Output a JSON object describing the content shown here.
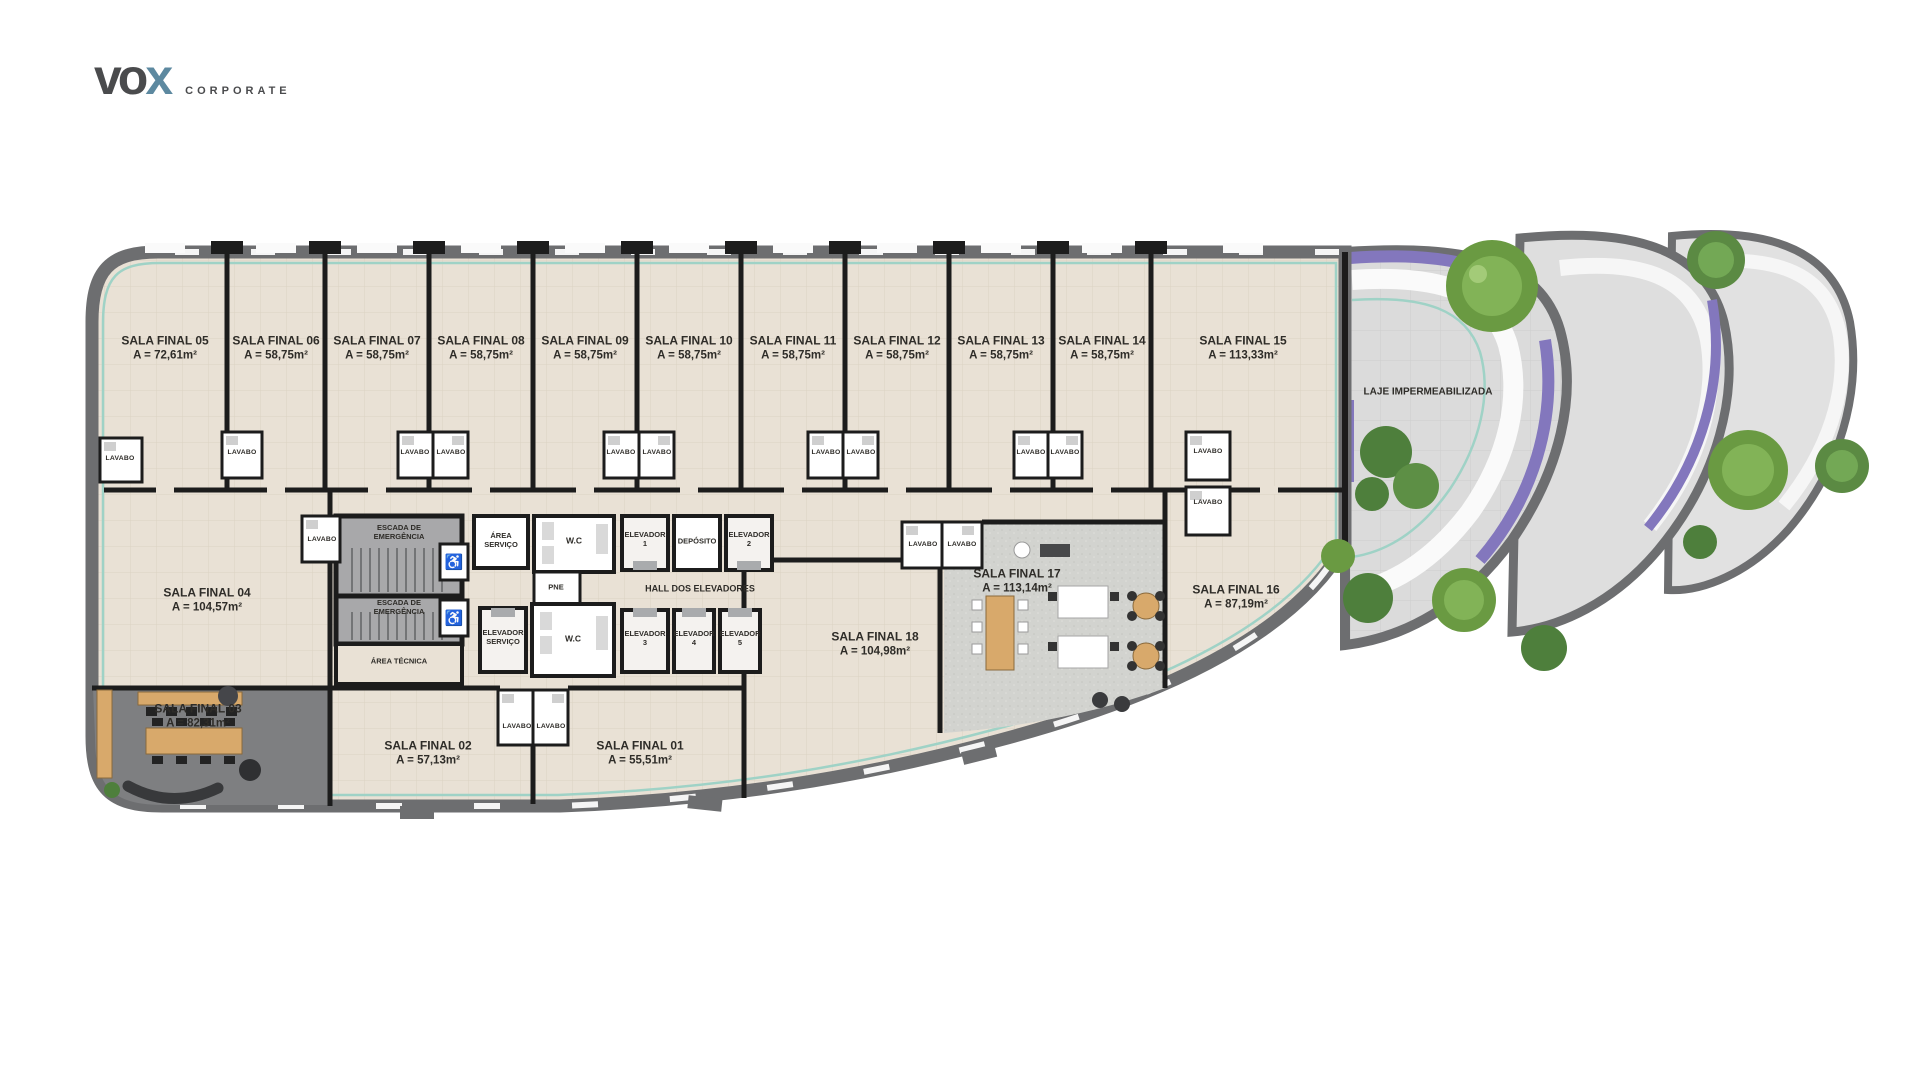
{
  "logo": {
    "part1": "vo",
    "part2": "x",
    "subtitle": "CORPORATE"
  },
  "labels": {
    "lavabo": "LAVABO"
  },
  "rooms_top": [
    {
      "name": "SALA FINAL 05",
      "area": "A = 72,61m²"
    },
    {
      "name": "SALA FINAL 06",
      "area": "A = 58,75m²"
    },
    {
      "name": "SALA FINAL 07",
      "area": "A = 58,75m²"
    },
    {
      "name": "SALA FINAL 08",
      "area": "A = 58,75m²"
    },
    {
      "name": "SALA FINAL 09",
      "area": "A = 58,75m²"
    },
    {
      "name": "SALA FINAL 10",
      "area": "A = 58,75m²"
    },
    {
      "name": "SALA FINAL 11",
      "area": "A = 58,75m²"
    },
    {
      "name": "SALA FINAL 12",
      "area": "A = 58,75m²"
    },
    {
      "name": "SALA FINAL 13",
      "area": "A = 58,75m²"
    },
    {
      "name": "SALA FINAL 14",
      "area": "A = 58,75m²"
    },
    {
      "name": "SALA FINAL 15",
      "area": "A = 113,33m²"
    }
  ],
  "rooms_other": [
    {
      "name": "SALA FINAL 04",
      "area": "A = 104,57m²"
    },
    {
      "name": "SALA FINAL 03",
      "area": "A = 82,31m²"
    },
    {
      "name": "SALA FINAL 02",
      "area": "A = 57,13m²"
    },
    {
      "name": "SALA FINAL 01",
      "area": "A = 55,51m²"
    },
    {
      "name": "SALA FINAL 18",
      "area": "A = 104,98m²"
    },
    {
      "name": "SALA FINAL 17",
      "area": "A = 113,14m²"
    },
    {
      "name": "SALA FINAL 16",
      "area": "A = 87,19m²"
    }
  ],
  "core": {
    "escada": "ESCADA DE EMERGÊNCIA",
    "area_servico": "ÁREA SERVIÇO",
    "wc": "W.C",
    "pne": "PNE",
    "deposito": "DEPÓSITO",
    "hall": "HALL DOS ELEVADORES",
    "elevador": "ELEVADOR",
    "servico": "SERVIÇO",
    "elev_nums": [
      "1",
      "2",
      "3",
      "4",
      "5"
    ],
    "area_tecnica": "ÁREA TÉCNICA"
  },
  "terrace": {
    "laje": "LAJE IMPERMEABILIZADA"
  },
  "colors": {
    "wall_gray": "#6d6e70",
    "wall_black": "#1c1c1c",
    "floor_beige": "#e9e1d5",
    "carpet_gray": "#d2d3cf",
    "dark_floor": "#7e7f81",
    "terrace_gray": "#dbdbdb",
    "accent_teal": "#9fd2c6",
    "flower_purple": "#8377bd",
    "tree_green": "#6a9a42",
    "palm_green": "#4e7f3c",
    "wood": "#d8a96b",
    "logo_x_blue": "#5d89a0",
    "logo_text": "#4a4b4d"
  }
}
